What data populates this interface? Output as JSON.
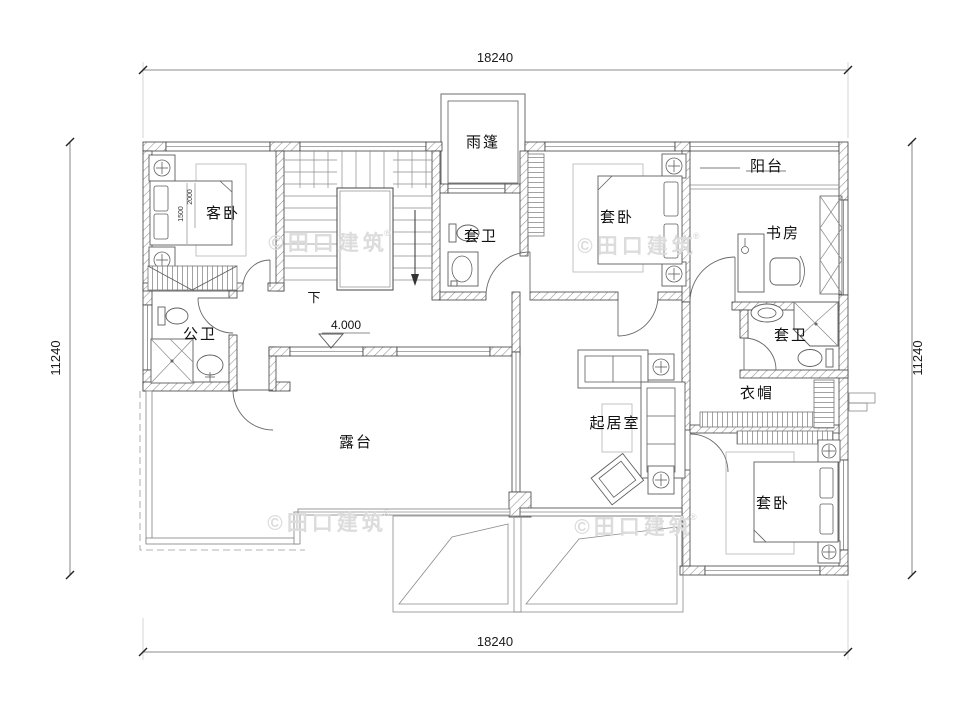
{
  "drawing": {
    "watermark": "©田口建筑",
    "watermark_reg": "®",
    "dims": {
      "top": "18240",
      "bottom": "18240",
      "left": "11240",
      "right": "11240"
    },
    "elevation": "4.000",
    "stair": {
      "down": "下"
    },
    "bed_dims": {
      "length": "2000",
      "width": "1500"
    },
    "rooms": {
      "canopy": "雨篷",
      "guest_bedroom": "客卧",
      "suite_bedroom_top": "套卧",
      "suite_bath_top": "套卫",
      "balcony": "阳台",
      "study": "书房",
      "public_bath": "公卫",
      "suite_bath_right": "套卫",
      "cloakroom": "衣帽",
      "living_room": "起居室",
      "terrace": "露台",
      "suite_bedroom_bottom": "套卧"
    },
    "colors": {
      "line": "#3f3f3f",
      "hatch": "#909090",
      "watermark": "#dcdcdc",
      "bg": "#ffffff"
    }
  }
}
